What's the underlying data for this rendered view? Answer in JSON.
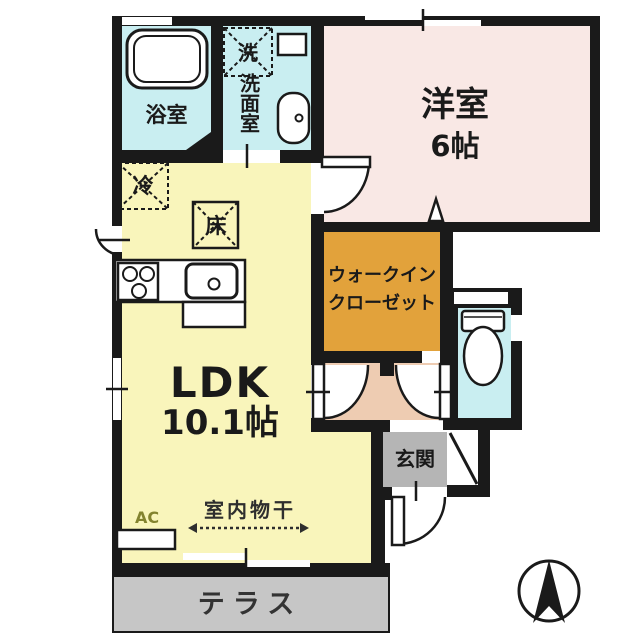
{
  "plan": {
    "title": "1LDK apartment floor plan",
    "rooms": {
      "bath": {
        "label": "浴室"
      },
      "washroom": {
        "label": "洗面室"
      },
      "western_room": {
        "label": "洋室",
        "size": "6帖"
      },
      "ldk": {
        "label": "LDK",
        "size": "10.1帖"
      },
      "walk_in_closet": {
        "label_line1": "ウォークイン",
        "label_line2": "クローゼット"
      },
      "genkan": {
        "label": "玄関"
      },
      "terrace": {
        "label": "テラス"
      }
    },
    "symbols": {
      "washer": "洗",
      "refrigerator": "冷",
      "floor_storage": "床",
      "indoor_laundry": "室内物干",
      "ac_unit": "AC"
    },
    "colors": {
      "wall": "#1a1a1a",
      "wet_area": "#c9eef1",
      "western_room": "#f9e8e5",
      "ldk": "#f9f5bb",
      "walk_in_closet": "#e2a23b",
      "hallway": "#eeccb2",
      "genkan": "#b5b5b5",
      "terrace": "#c6c6c6"
    }
  }
}
